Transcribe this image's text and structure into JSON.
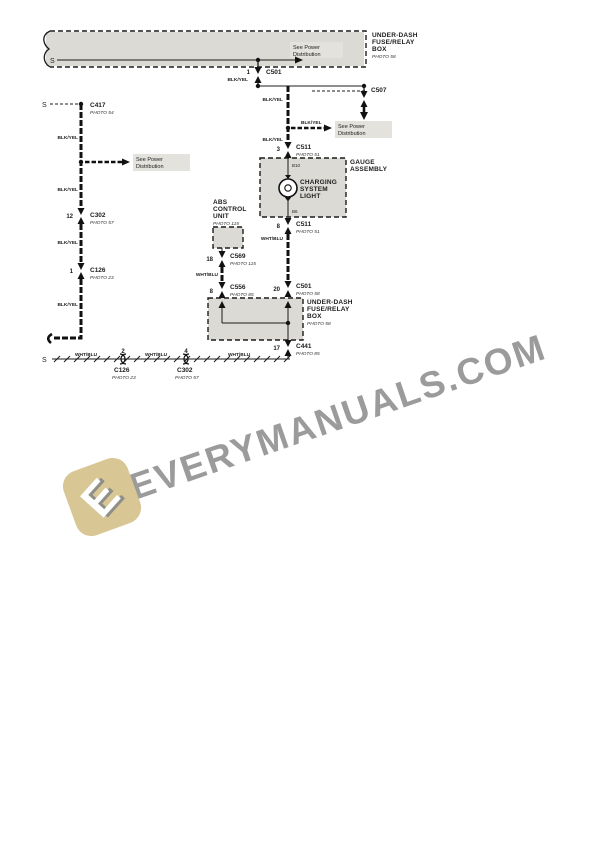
{
  "colors": {
    "line": "#1c1c1c",
    "box_fill": "#dbdad5",
    "highlight": "#e3e2dd",
    "watermark_text": "#9b9b9b",
    "logo_fill": "#d8c794"
  },
  "labels": {
    "splice": "S",
    "blk_yel": "BLK/YEL",
    "wht_blu": "WHT/BLU",
    "see_power_line1": "See Power",
    "see_power_line2": "Distribution"
  },
  "fuse_box_top": {
    "line1": "UNDER-DASH",
    "line2": "FUSE/RELAY",
    "line3": "BOX",
    "photo": "PHOTO 58"
  },
  "fuse_box_bottom": {
    "line1": "UNDER-DASH",
    "line2": "FUSE/RELAY",
    "line3": "BOX",
    "photo": "PHOTO 58"
  },
  "gauge_assembly": {
    "line1": "GAUGE",
    "line2": "ASSEMBLY",
    "pin_top": "B10",
    "pin_bottom": "B6",
    "bulb_line1": "CHARGING",
    "bulb_line2": "SYSTEM",
    "bulb_line3": "LIGHT"
  },
  "abs_unit": {
    "line1": "ABS",
    "line2": "CONTROL",
    "line3": "UNIT",
    "photo": "PHOTO 115"
  },
  "connectors": {
    "c501_top": {
      "pin": "1",
      "name": "C501"
    },
    "c507": {
      "name": "C507"
    },
    "c511_top": {
      "pin": "3",
      "name": "C511",
      "photo": "PHOTO 51"
    },
    "c511_bottom": {
      "pin": "8",
      "name": "C511",
      "photo": "PHOTO 51"
    },
    "c501_bottom": {
      "pin": "20",
      "name": "C501",
      "photo": "PHOTO 58"
    },
    "c441": {
      "pin": "17",
      "name": "C441",
      "photo": "PHOTO 85"
    },
    "c417": {
      "name": "C417",
      "photo": "PHOTO 54"
    },
    "c302_left": {
      "pin": "12",
      "name": "C302",
      "photo": "PHOTO 57"
    },
    "c126_left": {
      "pin": "1",
      "name": "C126",
      "photo": "PHOTO 23"
    },
    "c569": {
      "pin": "18",
      "name": "C569",
      "photo": "PHOTO 115"
    },
    "c556": {
      "pin": "8",
      "name": "C556",
      "photo": "PHOTO 85"
    },
    "c126_bottom": {
      "pin": "2",
      "name": "C126",
      "photo": "PHOTO 23"
    },
    "c302_bottom": {
      "pin": "4",
      "name": "C302",
      "photo": "PHOTO 57"
    }
  },
  "watermark": {
    "text": "EVERYMANUALS.COM",
    "logo_letter": "E"
  }
}
